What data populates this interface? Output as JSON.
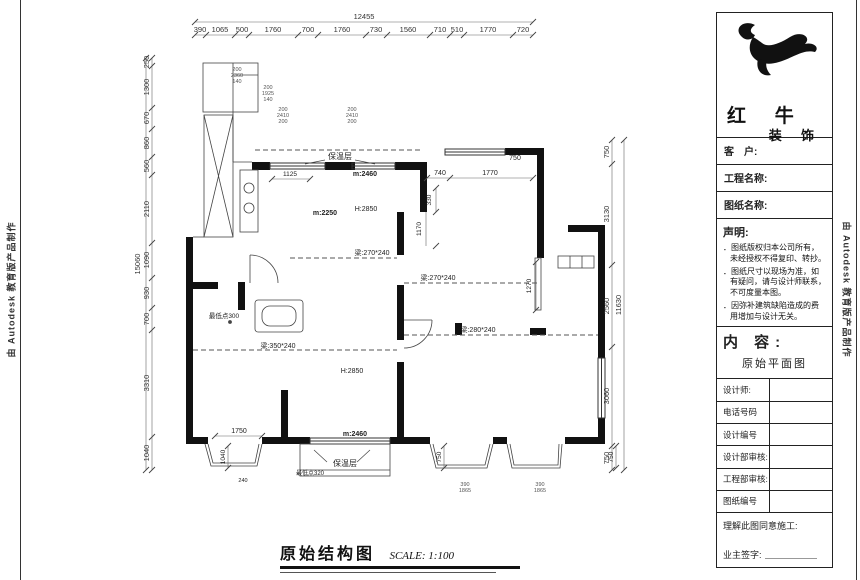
{
  "watermarks": {
    "left": "由 Autodesk 教育版产品制作",
    "right": "由 Autodesk 教育版产品制作"
  },
  "title_bar": {
    "title": "原始结构图",
    "scale": "SCALE: 1:100"
  },
  "dims": {
    "top_total": "12455",
    "top": [
      "390",
      "1065",
      "500",
      "1760",
      "700",
      "1760",
      "730",
      "1560",
      "710",
      "510",
      "1770",
      "720"
    ],
    "left_total": "15060",
    "left": [
      "250",
      "1300",
      "670",
      "860",
      "560",
      "2110",
      "1090",
      "930",
      "700",
      "3310",
      "1040"
    ],
    "right_total": "11630",
    "right": [
      "750",
      "3130",
      "2560",
      "3060",
      "750"
    ]
  },
  "labels": {
    "insulation_top": "保温层",
    "insulation_bottom": "保温层",
    "dim_1125": "1125",
    "win_top": "m:2460",
    "m2250": "m:2250",
    "h2850_top": "H:2850",
    "beam_270_a": "梁:270*240",
    "beam_270_b": "梁:270*240",
    "lowest_300": "最低点300",
    "beam_350": "梁:350*240",
    "beam_280": "梁:280*240",
    "h2850_bottom": "H:2850",
    "dim_1750": "1750",
    "win_bottom": "m:2460",
    "lowest_320": "最低点320",
    "dim_740": "740",
    "dim_1770": "1770",
    "dim_750_top": "750",
    "dim_330": "330",
    "dim_1170": "1170",
    "dim_1270": "1270",
    "dim_1040": "1040",
    "dim_750_a": "750",
    "dim_750_b": "750",
    "dim_240": "240"
  },
  "stacks": {
    "s1": [
      "200",
      "2360",
      "140"
    ],
    "s2": [
      "200",
      "1925",
      "140"
    ],
    "s3": [
      "200",
      "2410",
      "200"
    ],
    "s4": [
      "200",
      "2410",
      "200"
    ],
    "s5": [
      "390",
      "1865"
    ],
    "s6": [
      "390",
      "1865"
    ]
  },
  "titleblock": {
    "brand_top": "红 牛",
    "brand_bottom": "装 饰",
    "customer": "客　户:",
    "project": "工程名称:",
    "drawing": "图纸名称:",
    "statement_title": "声明:",
    "statement_1": "图纸版权归本公司所有，未经授权不得复印、转抄。",
    "statement_2": "图纸尺寸以现场为准，如有疑问，请与设计师联系，不可度量本图。",
    "statement_3": "因弥补建筑缺陷造成的费用增加与设计无关。",
    "content_title": "内 容:",
    "content_value": "原始平面图",
    "designer": "设计师:",
    "phone": "电话号码",
    "design_no": "设计编号",
    "design_audit": "设计部审核:",
    "eng_audit": "工程部审核:",
    "drawing_no": "图纸编号",
    "agree": "理解此图同意施工:",
    "owner_sign": "业主签字:"
  }
}
